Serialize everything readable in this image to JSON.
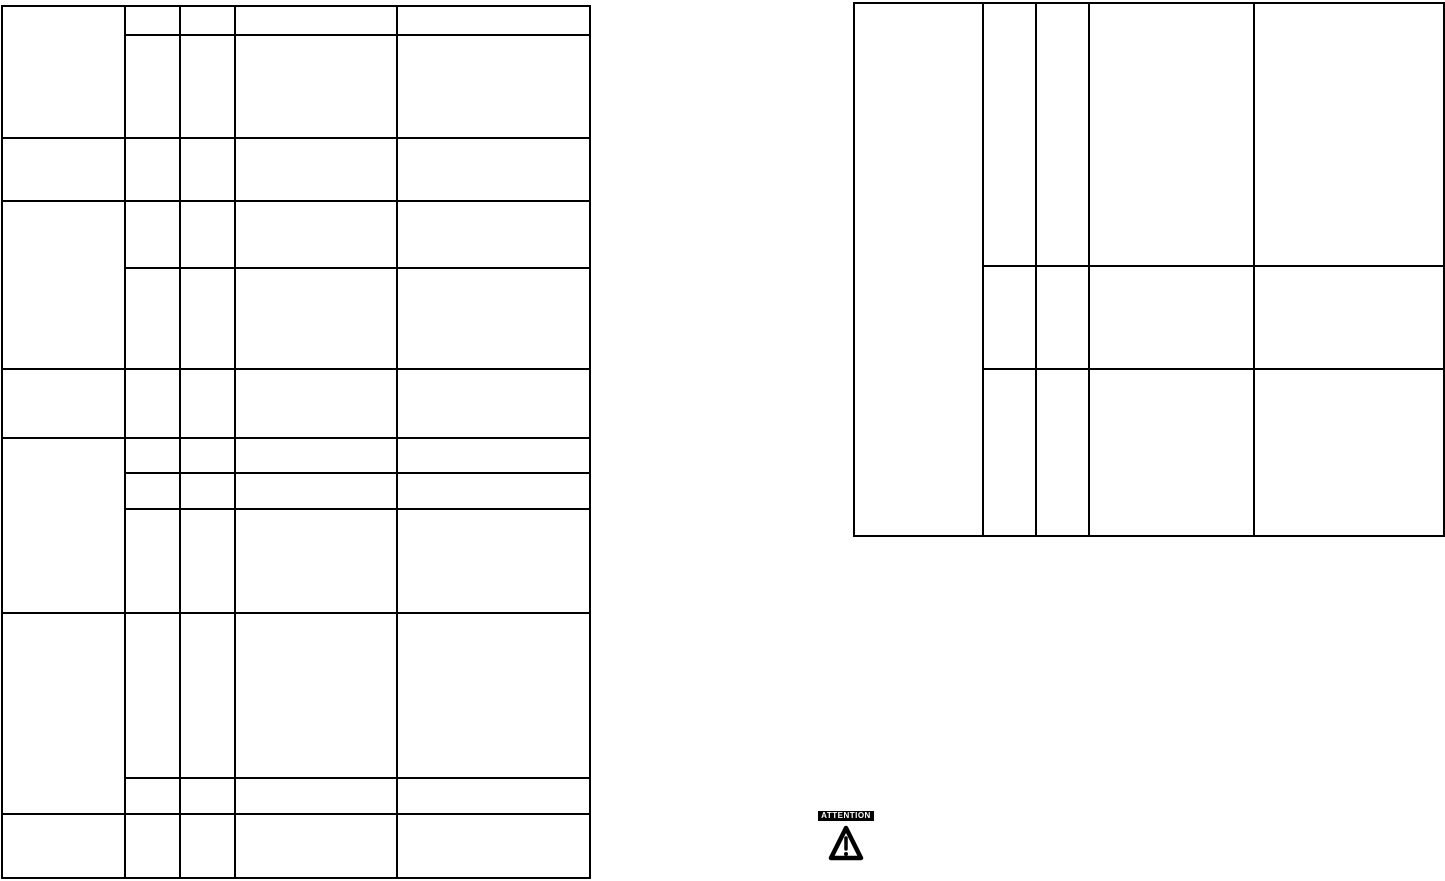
{
  "page": {
    "background_color": "#ffffff",
    "line_color": "#000000"
  },
  "attention": {
    "label": "ATTENTION",
    "icon": "warning-triangle-icon",
    "badge_bg": "#000000",
    "badge_fg": "#ffffff"
  },
  "tables": {
    "left": {
      "columns": 5,
      "rows": 12,
      "all_cells_empty": true
    },
    "right": {
      "columns": 5,
      "rows": 3,
      "all_cells_empty": true
    }
  }
}
